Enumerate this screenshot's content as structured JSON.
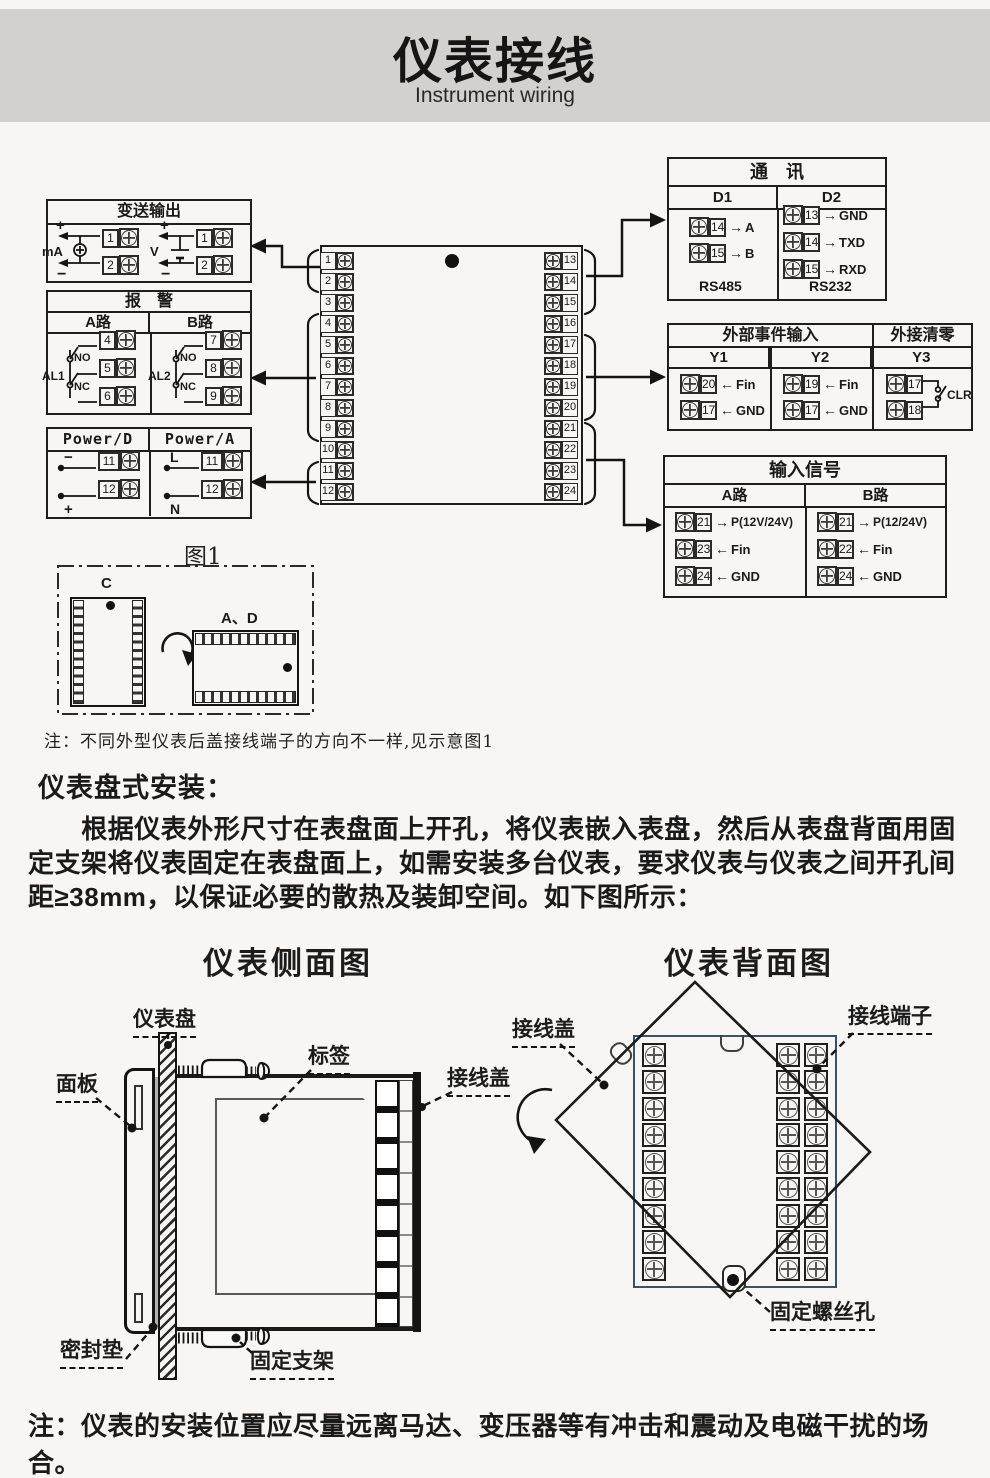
{
  "page": {
    "bg": "#f7f6f5",
    "header_bg": "#d3d1d0",
    "ink": "#1a1a1a",
    "block_border": "#3a5262"
  },
  "header": {
    "title": "仪表接线",
    "subtitle": "Instrument wiring"
  },
  "wiring": {
    "transmitter": {
      "title": "变送输出",
      "ma_label": "mA",
      "v_label": "V",
      "plus": "+",
      "minus": "−",
      "ma_terminals": [
        "1",
        "2"
      ],
      "v_terminals": [
        "1",
        "2"
      ]
    },
    "alarm": {
      "title": "报　警",
      "col_a": "A路",
      "col_b": "B路",
      "al1": "AL1",
      "al2": "AL2",
      "no": "NO",
      "nc": "NC",
      "a_terminals": [
        "4",
        "5",
        "6"
      ],
      "b_terminals": [
        "7",
        "8",
        "9"
      ]
    },
    "power": {
      "col_d": "Power/D",
      "col_a": "Power/A",
      "d_rows": [
        {
          "tag": "−",
          "num": "11"
        },
        {
          "tag": "+",
          "num": "12"
        }
      ],
      "a_rows": [
        {
          "tag": "L",
          "num": "11"
        },
        {
          "tag": "N",
          "num": "12"
        }
      ]
    },
    "block": {
      "left": [
        "1",
        "2",
        "3",
        "4",
        "5",
        "6",
        "7",
        "8",
        "9",
        "10",
        "11",
        "12"
      ],
      "right": [
        "13",
        "14",
        "15",
        "16",
        "17",
        "18",
        "19",
        "20",
        "21",
        "22",
        "23",
        "24"
      ]
    },
    "comm": {
      "title": "通　讯",
      "col1": "D1",
      "col2": "D2",
      "d1_rows": [
        {
          "num": "14",
          "dir": "→",
          "label": "A"
        },
        {
          "num": "15",
          "dir": "→",
          "label": "B"
        }
      ],
      "d1_caption": "RS485",
      "d2_rows": [
        {
          "num": "13",
          "dir": "→",
          "label": "GND"
        },
        {
          "num": "14",
          "dir": "→",
          "label": "TXD"
        },
        {
          "num": "15",
          "dir": "→",
          "label": "RXD"
        }
      ],
      "d2_caption": "RS232"
    },
    "event": {
      "title": "外部事件输入",
      "title2": "外接清零",
      "col1": "Y1",
      "col2": "Y2",
      "col3": "Y3",
      "y1_rows": [
        {
          "num": "20",
          "dir": "←",
          "label": "Fin"
        },
        {
          "num": "17",
          "dir": "←",
          "label": "GND"
        }
      ],
      "y2_rows": [
        {
          "num": "19",
          "dir": "←",
          "label": "Fin"
        },
        {
          "num": "17",
          "dir": "←",
          "label": "GND"
        }
      ],
      "y3_terminals": [
        "17",
        "18"
      ],
      "clr": "CLR"
    },
    "input": {
      "title": "输入信号",
      "col_a": "A路",
      "col_b": "B路",
      "a_rows": [
        {
          "num": "21",
          "dir": "→",
          "label": "P(12V/24V)"
        },
        {
          "num": "23",
          "dir": "←",
          "label": "Fin"
        },
        {
          "num": "24",
          "dir": "←",
          "label": "GND"
        }
      ],
      "b_rows": [
        {
          "num": "21",
          "dir": "→",
          "label": "P(12/24V)"
        },
        {
          "num": "22",
          "dir": "←",
          "label": "Fin"
        },
        {
          "num": "24",
          "dir": "←",
          "label": "GND"
        }
      ]
    }
  },
  "figure1": {
    "caption": "图1",
    "case_c": "C",
    "case_ad": "A、D"
  },
  "install": {
    "note1": "注：不同外型仪表后盖接线端子的方向不一样,见示意图1",
    "heading": "仪表盘式安装：",
    "paragraph": "根据仪表外形尺寸在表盘面上开孔，将仪表嵌入表盘，然后从表盘背面用固定支架将仪表固定在表盘面上，如需安装多台仪表，要求仪表与仪表之间开孔间距≥38mm，以保证必要的散热及装卸空间。如下图所示：",
    "note2": "注：仪表的安装位置应尽量远离马达、变压器等有冲击和震动及电磁干扰的场合。"
  },
  "side_view": {
    "title": "仪表侧面图",
    "labels": {
      "panel_board": "仪表盘",
      "front_panel": "面板",
      "tag": "标签",
      "wiring_cover": "接线盖",
      "gasket": "密封垫",
      "bracket": "固定支架"
    }
  },
  "back_view": {
    "title": "仪表背面图",
    "labels": {
      "wiring_cover": "接线盖",
      "terminal": "接线端子",
      "screw_hole": "固定螺丝孔"
    }
  }
}
